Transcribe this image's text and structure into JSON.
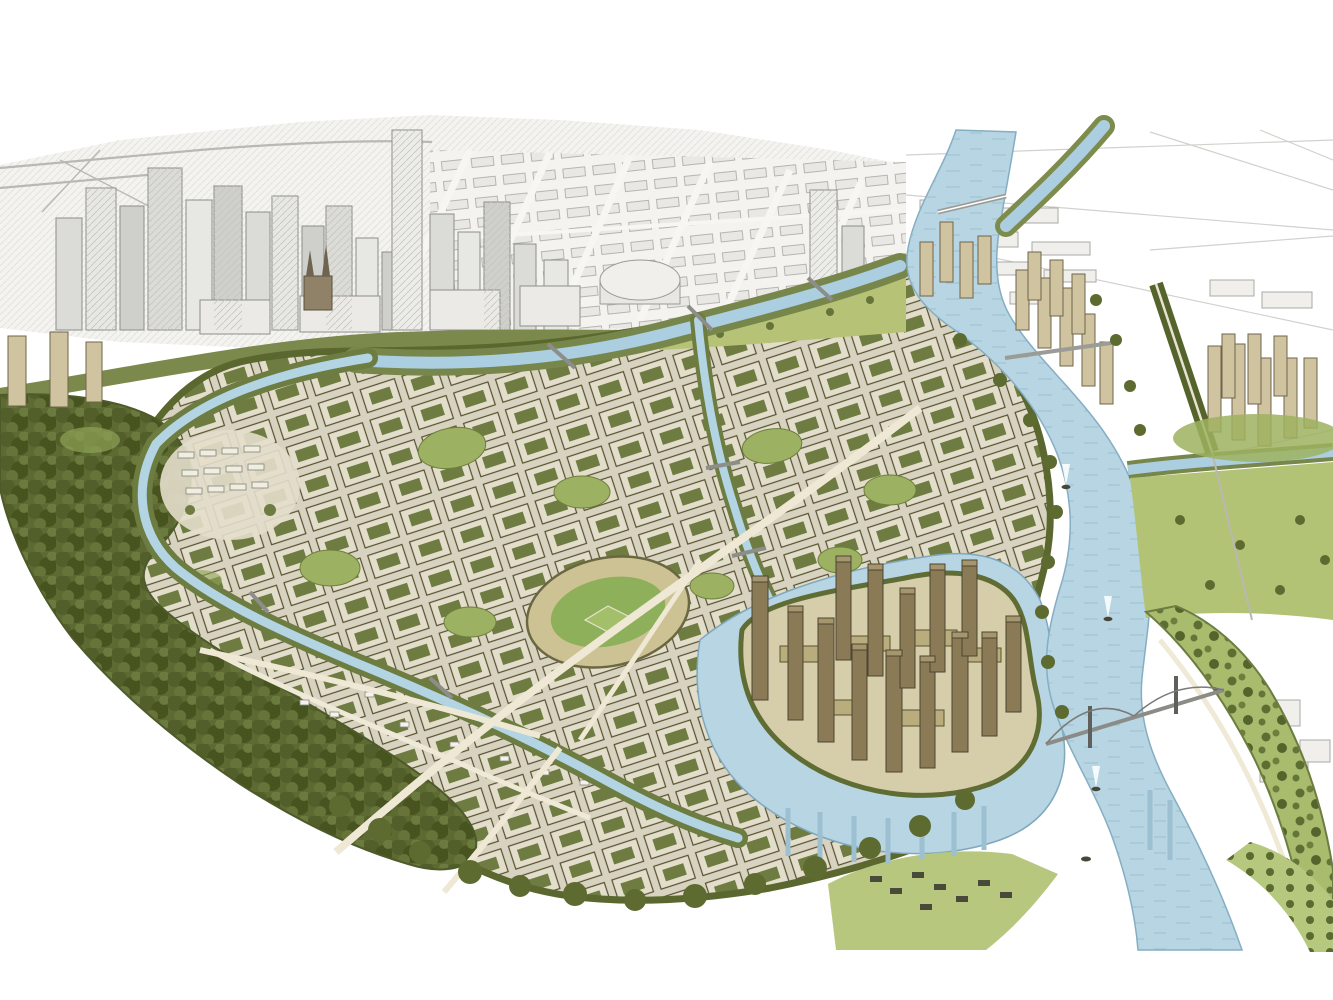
{
  "page": {
    "title": "URBANSIM"
  },
  "illustration": {
    "label": "hand-drawn aerial watercolor rendering of a riverfront urban plan",
    "features": [
      "pencil-sketched downtown skyline across the top",
      "winding rivers and creeks with bridges and small boats",
      "dense perimeter housing blocks with green courtyards",
      "central green stadium field",
      "brown high-rise tower cluster on a peninsula",
      "tan tower groups along the river bend and right edge",
      "dark olive forest along the left and bottom edges",
      "green park bank and orchard rows at bottom right"
    ],
    "colors": {
      "paper": "#ffffff",
      "title_ink": "#2d2d2d",
      "sketch_grey": "#9a9a96",
      "sketch_fill": "#efeeea",
      "water": "#b7d5e3",
      "water_edge": "#85aec2",
      "forest_dark": "#55632c",
      "courtyard_green": "#6e7b41",
      "meadow_green": "#aabc6d",
      "field_green": "#8fb05a",
      "block_roof": "#e3decb",
      "block_wall": "#5a553b",
      "street_cream": "#d8d3c0",
      "tower_tan": "#cfc3a0",
      "tower_brown": "#8a7a55"
    }
  }
}
